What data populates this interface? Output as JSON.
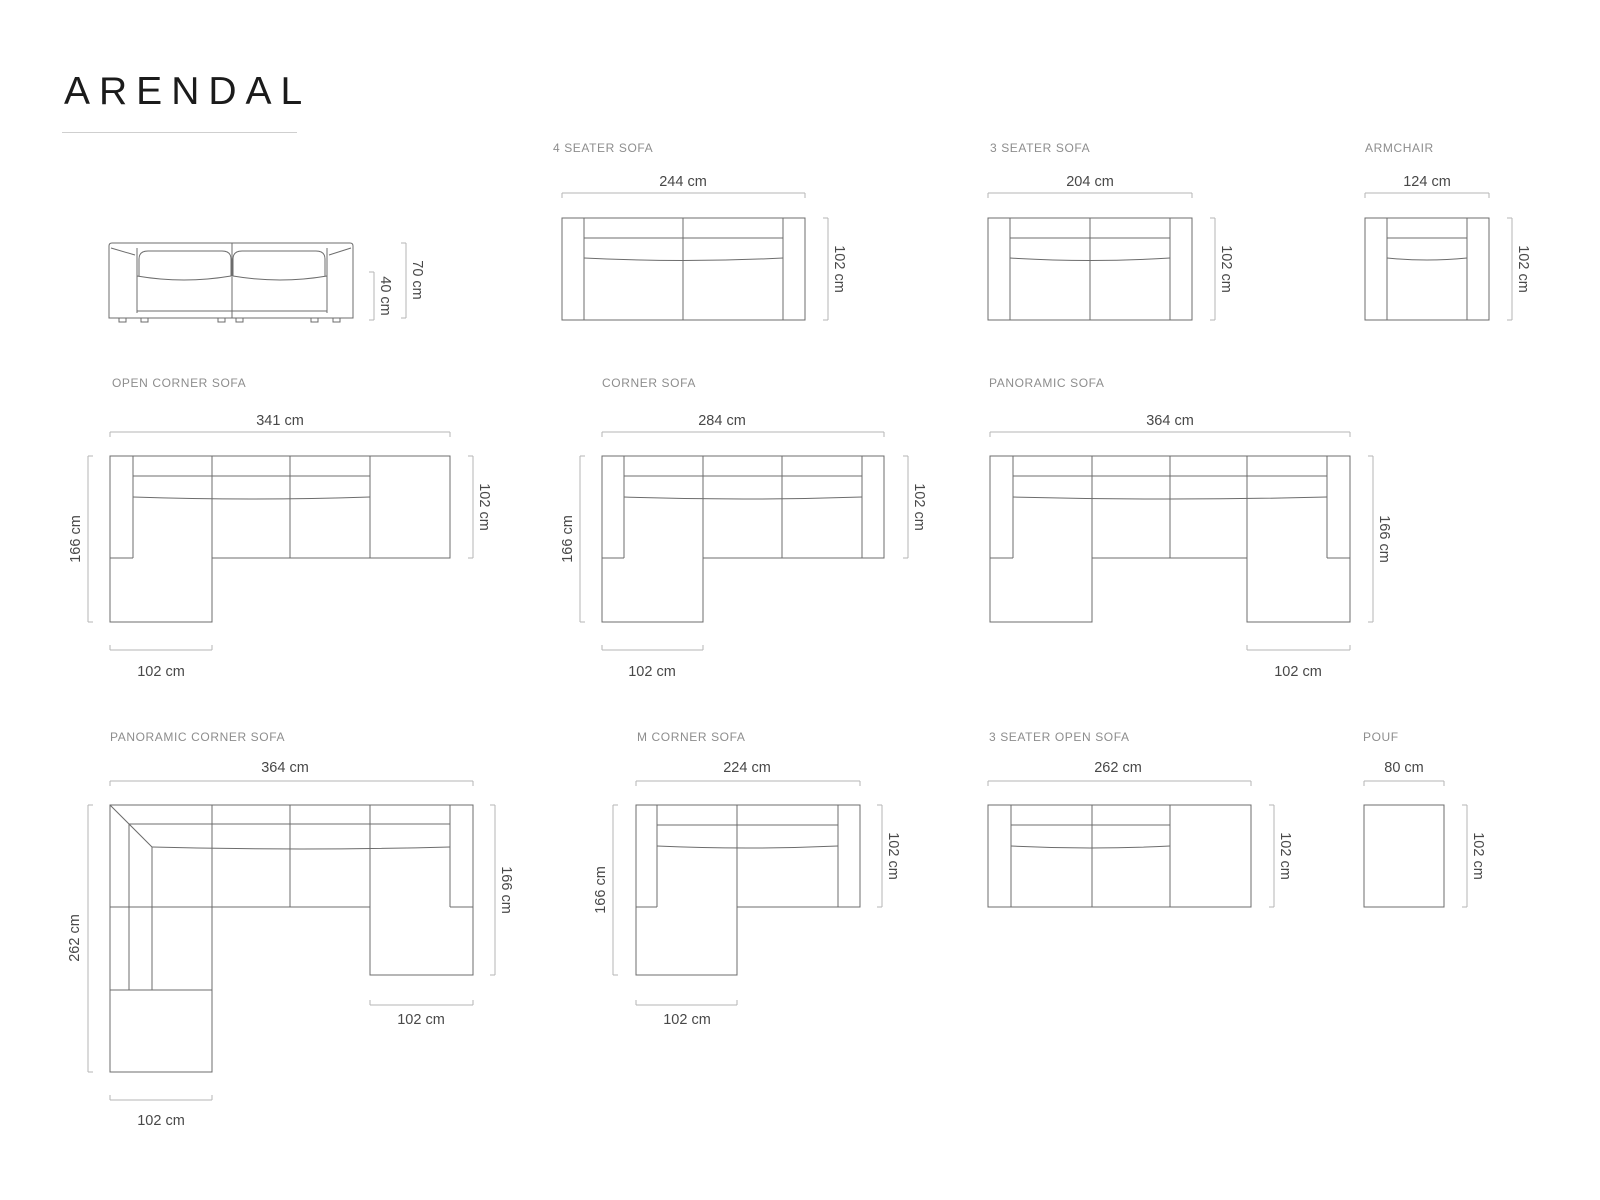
{
  "page": {
    "title": "ARENDAL"
  },
  "items": {
    "side_view": {
      "dim_height": "70 cm",
      "dim_seat_height": "40 cm"
    },
    "four_seater": {
      "label": "4 SEATER SOFA",
      "dim_width": "244 cm",
      "dim_depth": "102 cm"
    },
    "three_seater": {
      "label": "3 SEATER SOFA",
      "dim_width": "204 cm",
      "dim_depth": "102 cm"
    },
    "armchair": {
      "label": "ARMCHAIR",
      "dim_width": "124 cm",
      "dim_depth": "102 cm"
    },
    "open_corner": {
      "label": "OPEN CORNER SOFA",
      "dim_width": "341 cm",
      "dim_depth_total": "166 cm",
      "dim_depth": "102 cm",
      "dim_chaise": "102 cm"
    },
    "corner": {
      "label": "CORNER SOFA",
      "dim_width": "284 cm",
      "dim_depth_total": "166 cm",
      "dim_depth": "102 cm",
      "dim_chaise": "102 cm"
    },
    "panoramic": {
      "label": "PANORAMIC SOFA",
      "dim_width": "364 cm",
      "dim_depth_total": "166 cm",
      "dim_chaise": "102 cm"
    },
    "panoramic_corner": {
      "label": "PANORAMIC CORNER SOFA",
      "dim_width": "364 cm",
      "dim_side_left": "262 cm",
      "dim_side_right": "166 cm",
      "dim_chaise_right": "102 cm",
      "dim_chaise_bottom": "102 cm"
    },
    "m_corner": {
      "label": "M CORNER SOFA",
      "dim_width": "224 cm",
      "dim_depth_total": "166 cm",
      "dim_depth": "102 cm",
      "dim_chaise": "102 cm"
    },
    "three_seater_open": {
      "label": "3 SEATER OPEN SOFA",
      "dim_width": "262 cm",
      "dim_depth": "102 cm"
    },
    "pouf": {
      "label": "POUF",
      "dim_width": "80 cm",
      "dim_depth": "102 cm"
    }
  }
}
